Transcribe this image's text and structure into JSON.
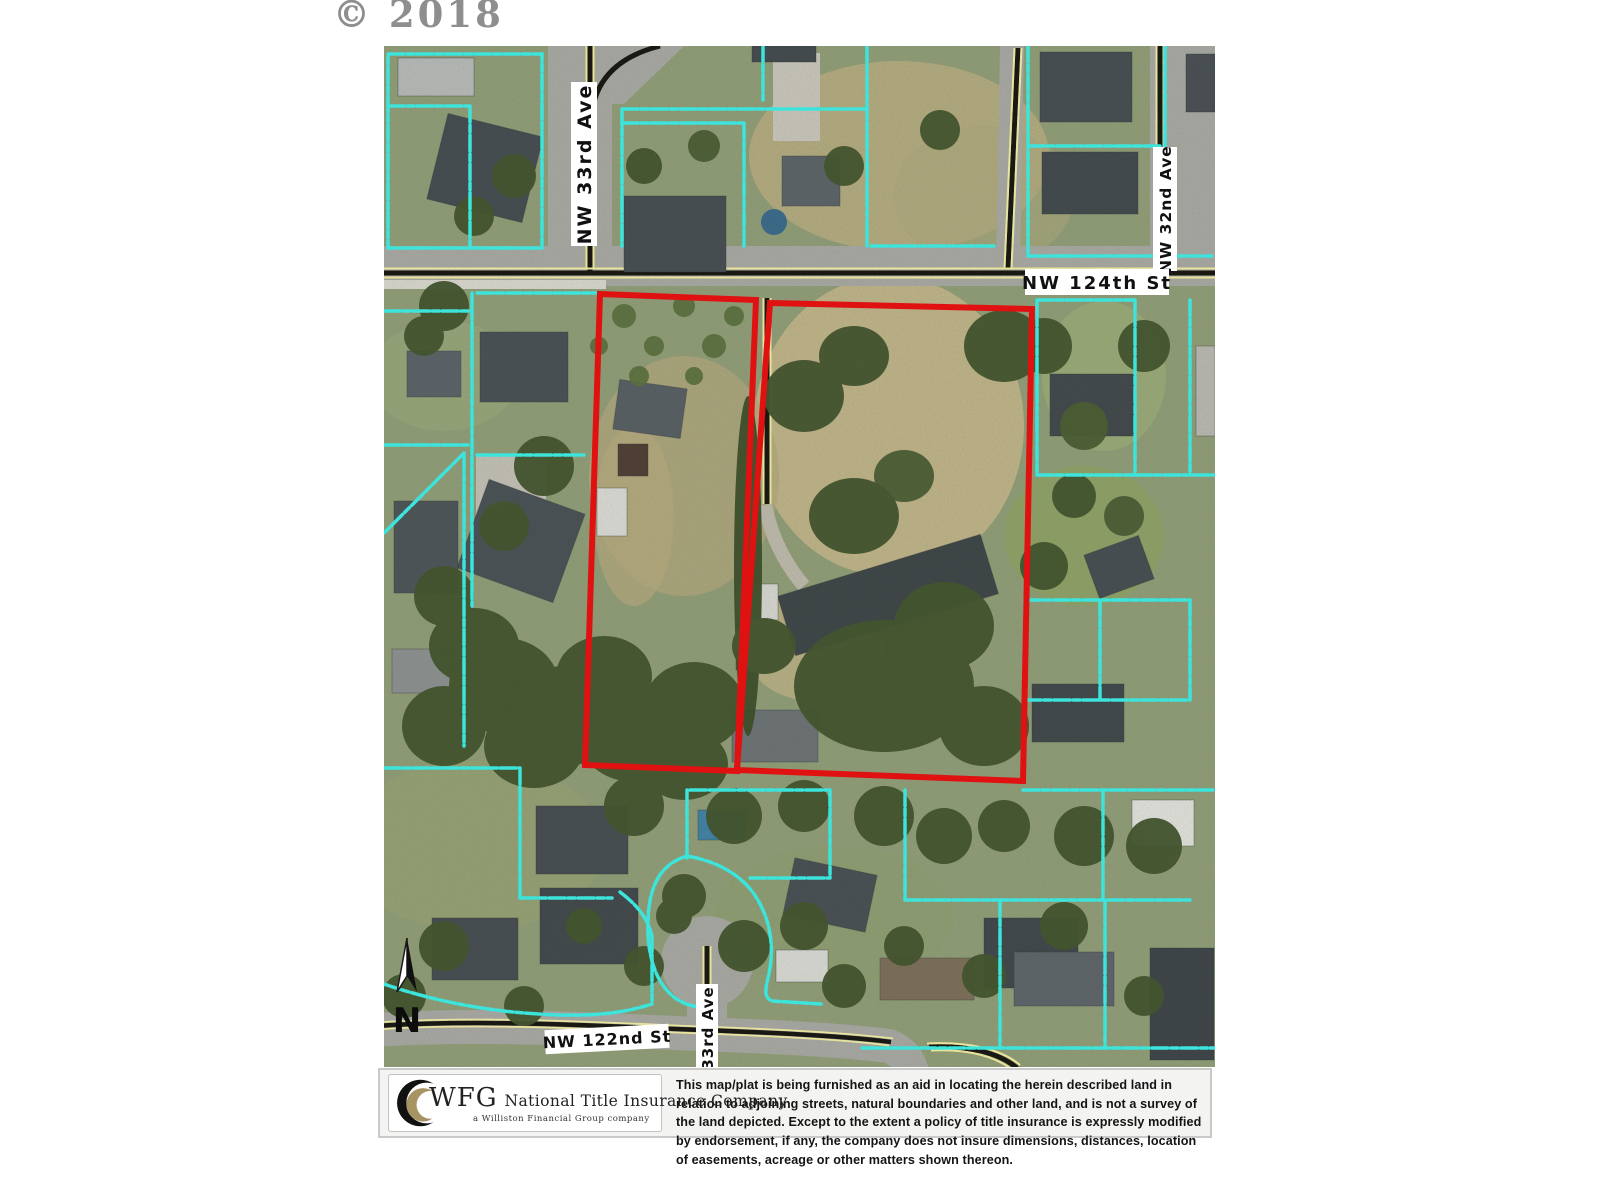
{
  "watermark": {
    "text": "© 2018"
  },
  "map": {
    "street_labels": [
      {
        "name": "NW 33rd Ave"
      },
      {
        "name": "NW 32nd Ave"
      },
      {
        "name": "NW 124th St"
      },
      {
        "name": "NW 122nd St"
      },
      {
        "name": "33rd Ave"
      }
    ],
    "north_arrow_label": "N",
    "colors": {
      "subject_parcel_outline": "#e01111",
      "parcel_boundary": "#3ce4dc",
      "road_centerline_yellow": "#f3eda2",
      "road_surface": "#a7a7a3"
    }
  },
  "footer": {
    "logo": {
      "acronym": "WFG",
      "company_name": "National Title Insurance Company",
      "tagline": "a Williston Financial Group company"
    },
    "disclaimer": "This map/plat is being furnished as an aid in locating the herein described land in relation to adjoining streets, natural boundaries and other land, and is not a survey of the land depicted. Except to the extent a policy of title insurance is expressly modified by endorsement, if any, the company does not insure dimensions, distances, location of easements, acreage or other matters shown thereon."
  }
}
